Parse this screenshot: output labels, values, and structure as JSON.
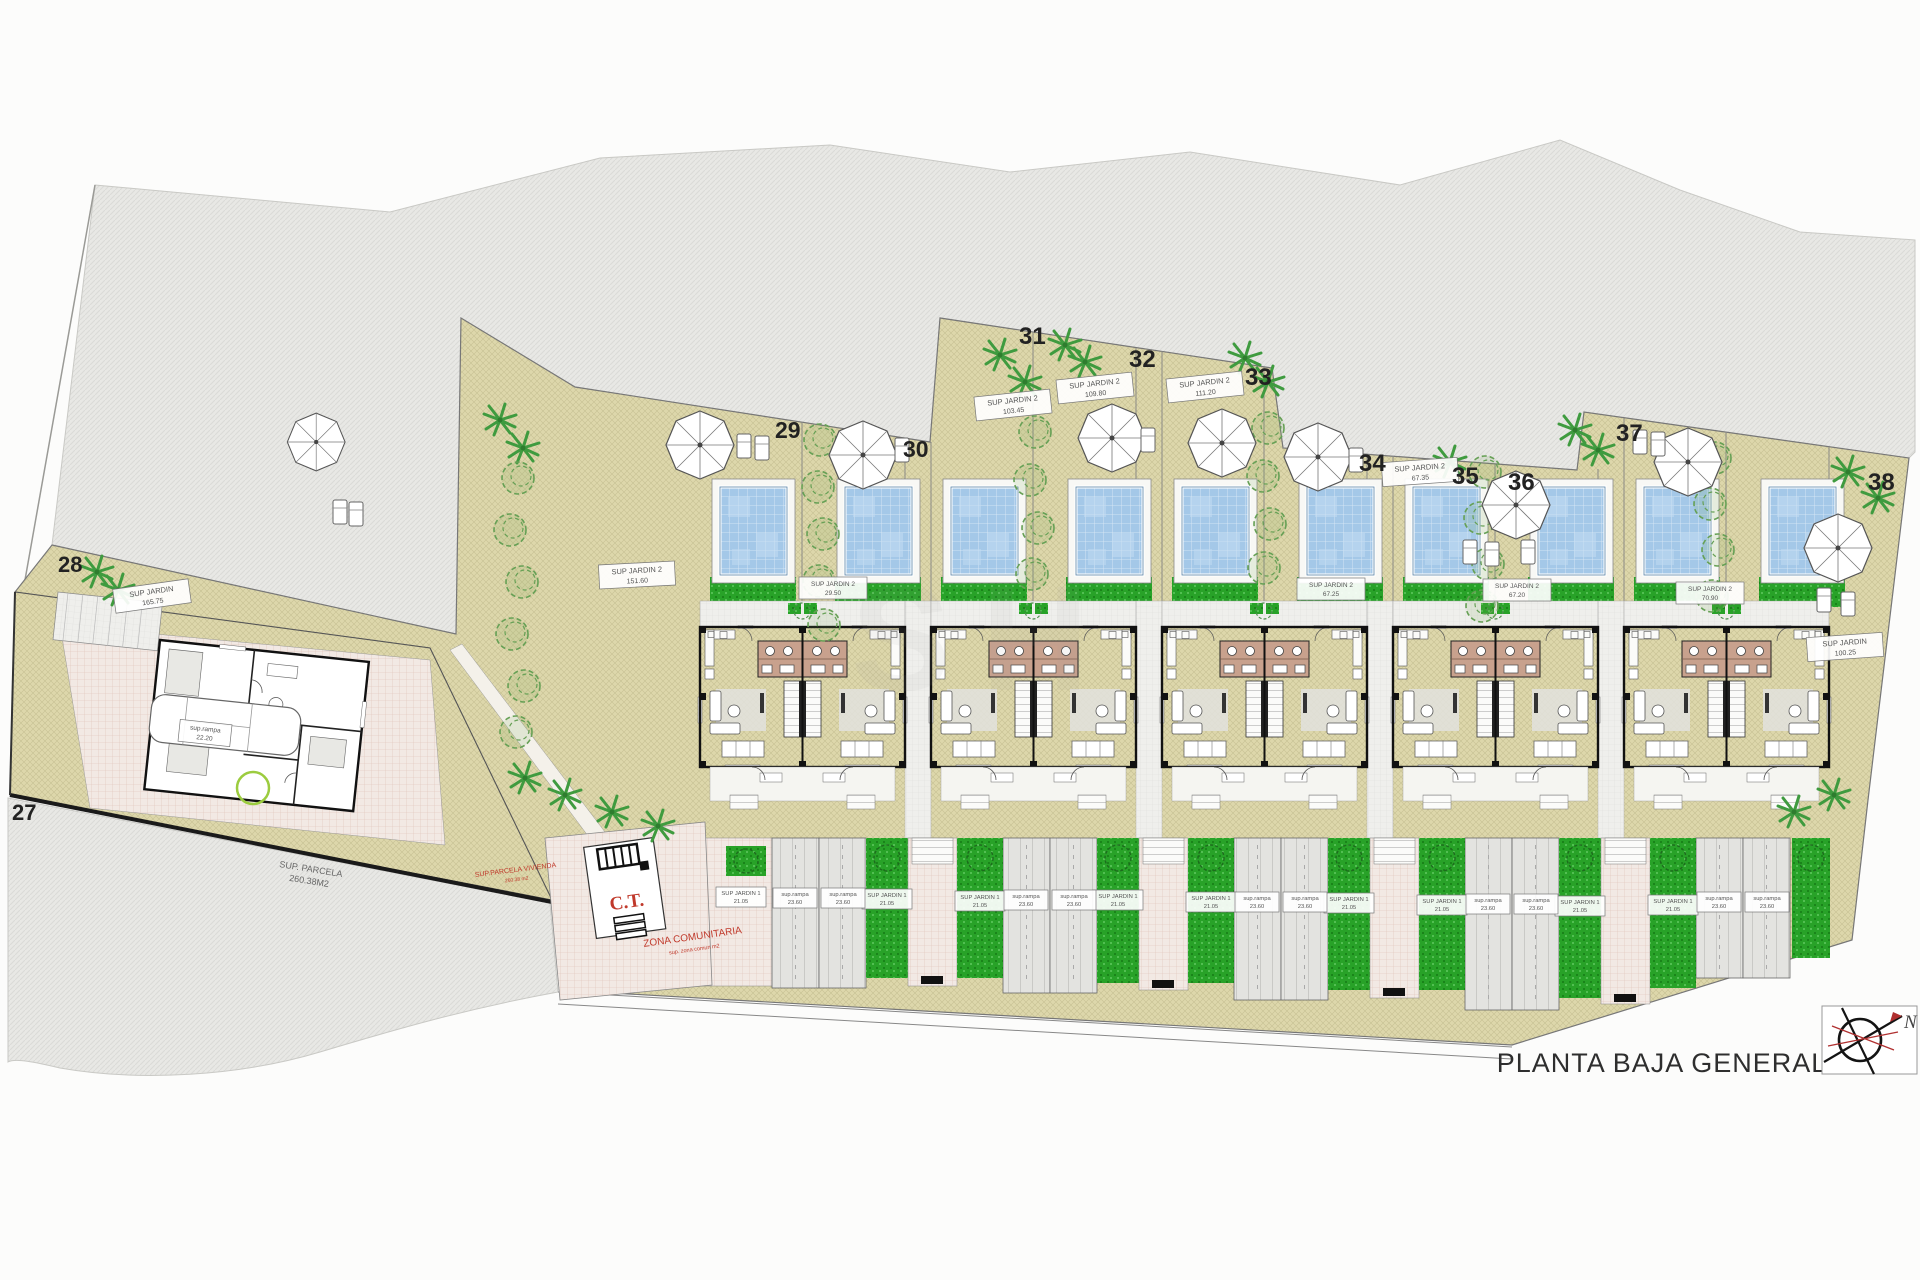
{
  "title": "PLANTA BAJA GENERAL",
  "compass": {
    "north_label": "N"
  },
  "watermark": "SH",
  "colors": {
    "garden_beige": "#ddd7ab",
    "lawn_green": "#28a228",
    "pool_blue": "#a4c8e8",
    "terrain_gray": "#e8e8e5",
    "accent_red": "#c0392b"
  },
  "plots": {
    "p27": "27",
    "p28": "28",
    "p29": "29",
    "p30": "30",
    "p31": "31",
    "p32": "32",
    "p33": "33",
    "p34": "34",
    "p35": "35",
    "p36": "36",
    "p37": "37",
    "p38": "38"
  },
  "labels": {
    "jardin28": {
      "l1": "SUP JARDIN",
      "l2": "165.75"
    },
    "jardin29": {
      "l1": "SUP JARDIN 2",
      "l2": "151.60"
    },
    "jardin30": {
      "l1": "SUP JARDIN 2",
      "l2": "29.50"
    },
    "jardin31": {
      "l1": "SUP JARDIN 2",
      "l2": "103.45"
    },
    "jardin32": {
      "l1": "SUP JARDIN 2",
      "l2": "109.80"
    },
    "jardin33": {
      "l1": "SUP JARDIN 2",
      "l2": "111.20"
    },
    "jardin34": {
      "l1": "SUP JARDIN 2",
      "l2": "67.25"
    },
    "jardin35": {
      "l1": "SUP JARDIN 2",
      "l2": "67.35"
    },
    "jardin36": {
      "l1": "SUP JARDIN 2",
      "l2": "67.20"
    },
    "jardin37": {
      "l1": "SUP JARDIN 2",
      "l2": "70.90"
    },
    "jardin38": {
      "l1": "SUP JARDIN",
      "l2": "100.25"
    },
    "jardin1": {
      "l1": "SUP JARDIN 1",
      "l2": "21.05"
    },
    "rampa": {
      "l1": "sup.rampa",
      "l2": "23.60"
    },
    "villa_rampa": {
      "l1": "sup.rampa",
      "l2": "22.20"
    },
    "parcela": {
      "l1": "SUP. PARCELA",
      "l2": "260.38M2"
    },
    "parcela_red": {
      "l1": "SUP.PARCELA VIVIENDA",
      "l2": "260.38 m2"
    },
    "zona": {
      "l1": "ZONA COMUNITARIA",
      "l2": "sup. zona comun m2"
    },
    "ct": "C.T."
  }
}
